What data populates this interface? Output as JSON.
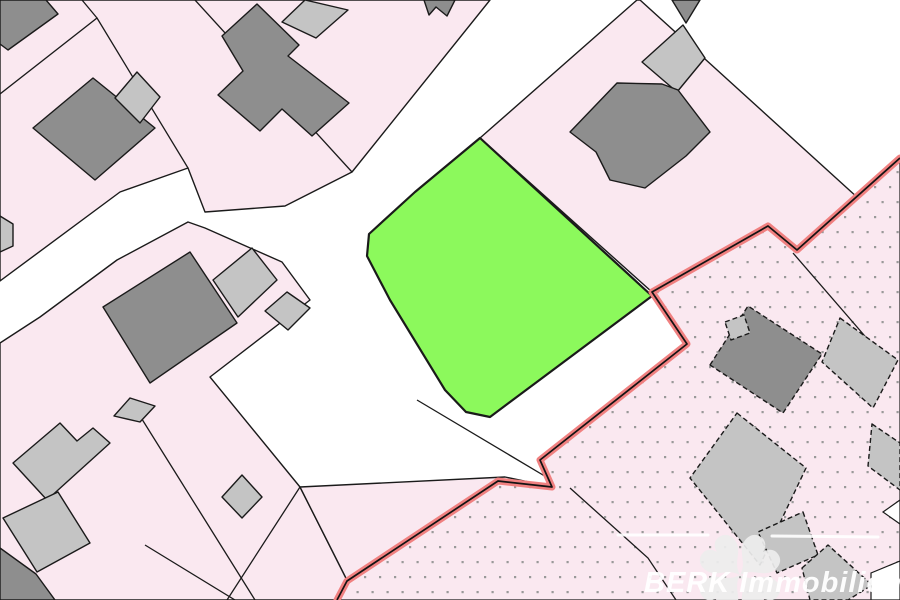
{
  "map": {
    "canvas": {
      "width": 900,
      "height": 600
    },
    "palette": {
      "background_white": "#ffffff",
      "parcel_pink": "#fae8f0",
      "building_dark": "#8e8e8e",
      "building_light": "#c4c4c4",
      "outline_black": "#1a1a1a",
      "highlight_green": "#8cf95c",
      "boundary_red": "#f08080",
      "boundary_red_core": "#131313",
      "dot_gray": "#999999"
    },
    "parcels": [
      {
        "name": "parcel-block-northwest",
        "points": "0,0 490,0 352,172 285,206 205,212 188,168 120,192 0,281"
      },
      {
        "name": "parcel-block-northeast",
        "points": "640,0 858,198 797,250 768,226 652,292 480,138 637,0"
      },
      {
        "name": "parcel-block-southwest",
        "points": "0,343 40,317 117,260 188,222 205,228 282,262 310,300 210,377 300,487 357,600 0,600"
      },
      {
        "name": "parcel-strip-south",
        "points": "300,487 505,477 553,487 347,581 337,600 357,600"
      }
    ],
    "restricted_region": {
      "name": "dotted-region-southeast",
      "points": "900,158 797,250 768,226 652,292 687,344 540,460 552,487 498,481 347,581 337,600 900,600"
    },
    "boundary_lines": [
      {
        "name": "parcel-line-nw-corner",
        "points": "82,0 97,18 0,94"
      },
      {
        "name": "parcel-line-nw-inner",
        "points": "97,18 188,168"
      },
      {
        "name": "parcel-line-north-diagonal",
        "points": "195,0 352,172"
      },
      {
        "name": "parcel-line-sw-long",
        "points": "130,400 255,600"
      },
      {
        "name": "parcel-line-sw-short",
        "points": "145,545 235,600"
      },
      {
        "name": "parcel-line-sw-split",
        "points": "300,487 227,600"
      },
      {
        "name": "parcel-line-road-end",
        "points": "417,400 548,478"
      },
      {
        "name": "parcel-line-dotted-south",
        "points": "570,488 648,558 676,600"
      },
      {
        "name": "parcel-line-dotted-east",
        "points": "793,253 883,357"
      }
    ],
    "buildings": [
      {
        "name": "building-dark-nw-corner",
        "shade": "dark",
        "points": "0,0 46,0 58,14 8,50 0,44"
      },
      {
        "name": "building-dark-nw",
        "shade": "dark",
        "points": "93,78 155,128 95,180 33,128"
      },
      {
        "name": "building-light-nw",
        "shade": "light",
        "points": "137,72 160,97 140,123 115,98"
      },
      {
        "name": "building-light-edge-west",
        "shade": "light",
        "points": "0,216 13,224 13,246 0,252"
      },
      {
        "name": "building-dark-north-large",
        "shade": "dark",
        "points": "222,36 257,4 299,45 288,56 349,103 312,136 282,109 260,131 218,95 243,71"
      },
      {
        "name": "building-light-north-roof",
        "shade": "light",
        "points": "282,22 305,0 348,10 316,38"
      },
      {
        "name": "building-dark-top-notch",
        "shade": "dark",
        "points": "424,0 455,0 447,16 436,7 429,15"
      },
      {
        "name": "building-dark-top-ne",
        "shade": "dark",
        "points": "672,0 700,0 686,23"
      },
      {
        "name": "building-light-ne-annex",
        "shade": "light",
        "points": "683,25 705,58 677,92 642,62"
      },
      {
        "name": "building-dark-ne-large",
        "shade": "dark",
        "points": "570,132 617,83 662,84 678,90 710,132 686,156 645,188 610,180 596,152"
      },
      {
        "name": "building-dark-west-large",
        "shade": "dark",
        "points": "190,252 237,323 150,383 103,307"
      },
      {
        "name": "building-light-west-a",
        "shade": "light",
        "points": "252,248 277,280 238,317 213,280"
      },
      {
        "name": "building-light-west-b",
        "shade": "light",
        "points": "287,292 310,308 288,330 265,311"
      },
      {
        "name": "building-light-small-diamond",
        "shade": "light",
        "points": "242,475 262,497 242,518 222,497"
      },
      {
        "name": "building-light-cluster-a",
        "shade": "light",
        "points": "60,423 77,441 93,428 110,443 47,500 13,463"
      },
      {
        "name": "building-light-cluster-b",
        "shade": "light",
        "points": "58,492 90,543 37,572 3,518"
      },
      {
        "name": "building-light-cluster-c",
        "shade": "light",
        "points": "130,398 155,406 140,422 114,416"
      },
      {
        "name": "building-dark-sw-corner",
        "shade": "dark",
        "points": "0,548 36,574 55,600 0,600"
      },
      {
        "name": "building-dark-dotted-main",
        "shade": "dark",
        "dashed": true,
        "points": "710,365 748,306 822,354 783,413"
      },
      {
        "name": "building-light-dotted-annex",
        "shade": "light",
        "dashed": true,
        "points": "725,322 744,315 750,333 731,340"
      },
      {
        "name": "building-light-dotted-large",
        "shade": "light",
        "dashed": true,
        "points": "737,413 806,468 760,565 690,478"
      },
      {
        "name": "building-light-dotted-lower",
        "shade": "light",
        "dashed": true,
        "points": "803,512 818,555 777,573 758,532"
      },
      {
        "name": "building-light-edge-east-a",
        "shade": "light",
        "dashed": true,
        "points": "840,318 898,360 873,408 822,362"
      },
      {
        "name": "building-light-edge-east-b",
        "shade": "light",
        "dashed": true,
        "points": "872,424 900,443 900,490 868,466"
      },
      {
        "name": "building-light-dotted-corner",
        "shade": "light",
        "dashed": true,
        "points": "802,568 828,545 872,585 848,600 810,600"
      }
    ],
    "highlight_parcel": {
      "name": "highlighted-parcel-green",
      "points": "480,138 652,296 490,417 466,412 445,390 390,300 367,256 369,234 415,192"
    },
    "red_boundary": {
      "name": "red-boundary-line",
      "points": "900,158 797,250 768,226 652,292 687,344 540,460 552,487 498,481 347,581 337,600"
    },
    "white_patches": [
      {
        "name": "white-patch-se-corner",
        "points": "871,600 871,573 900,561 900,600"
      },
      {
        "name": "white-notch-east-edge",
        "points": "883,512 900,500 900,524"
      }
    ],
    "watermark": {
      "text": "BERK Immobilien",
      "lines": [
        {
          "x1": 618,
          "y1": 535,
          "x2": 708,
          "y2": 535
        },
        {
          "x1": 772,
          "y1": 536,
          "x2": 878,
          "y2": 537
        }
      ]
    }
  }
}
